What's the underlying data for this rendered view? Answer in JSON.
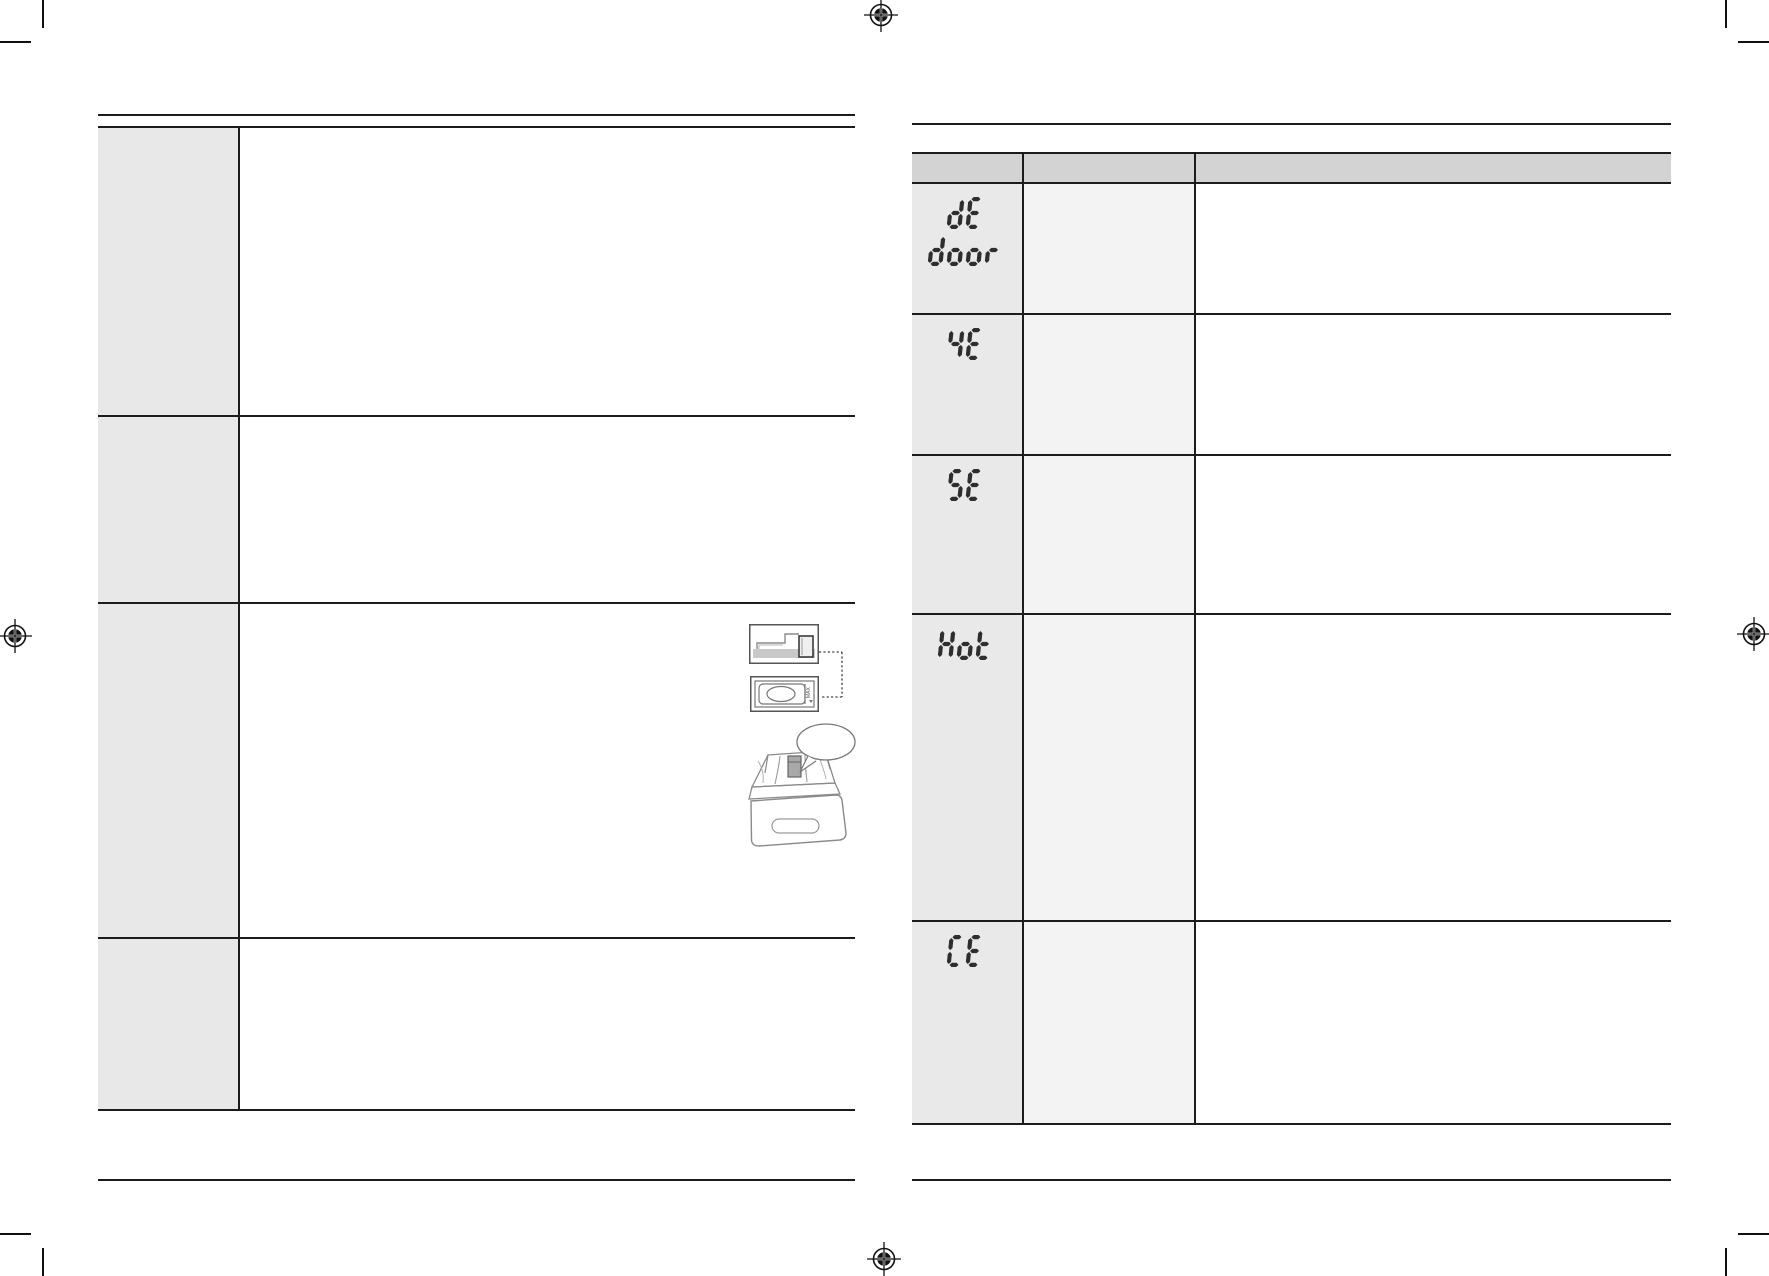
{
  "colors": {
    "paper": "#ffffff",
    "table_border": "#1c1c1c",
    "left_label_column_fill": "#e8e8e8",
    "right_header_fill": "#d3d3d3",
    "right_code_column_fill": "#e9e9e9",
    "right_middle_column_fill": "#f3f3f3",
    "seg_display": "#2e2e2e",
    "illustration_stroke": "#808080"
  },
  "left_table": {
    "rows": [
      {
        "label": "",
        "content": ""
      },
      {
        "label": "",
        "content": ""
      },
      {
        "label": "",
        "content": ""
      },
      {
        "label": "",
        "content": ""
      }
    ]
  },
  "right_table": {
    "header": [
      "",
      "",
      ""
    ],
    "rows": [
      {
        "code_lines": [
          "dE",
          "door"
        ],
        "middle": "",
        "right": ""
      },
      {
        "code_lines": [
          "4E"
        ],
        "middle": "",
        "right": ""
      },
      {
        "code_lines": [
          "5E"
        ],
        "middle": "",
        "right": ""
      },
      {
        "code_lines": [
          "Hot"
        ],
        "middle": "",
        "right": ""
      },
      {
        "code_lines": [
          "CE"
        ],
        "middle": "",
        "right": ""
      }
    ]
  },
  "illustrations": {
    "max_label": "MAX",
    "items": [
      "dispenser-side-view",
      "dispenser-top-view",
      "detergent-drawer-callout"
    ]
  },
  "print_marks": {
    "registration_marks": 4,
    "corner_crop_marks": 4
  }
}
